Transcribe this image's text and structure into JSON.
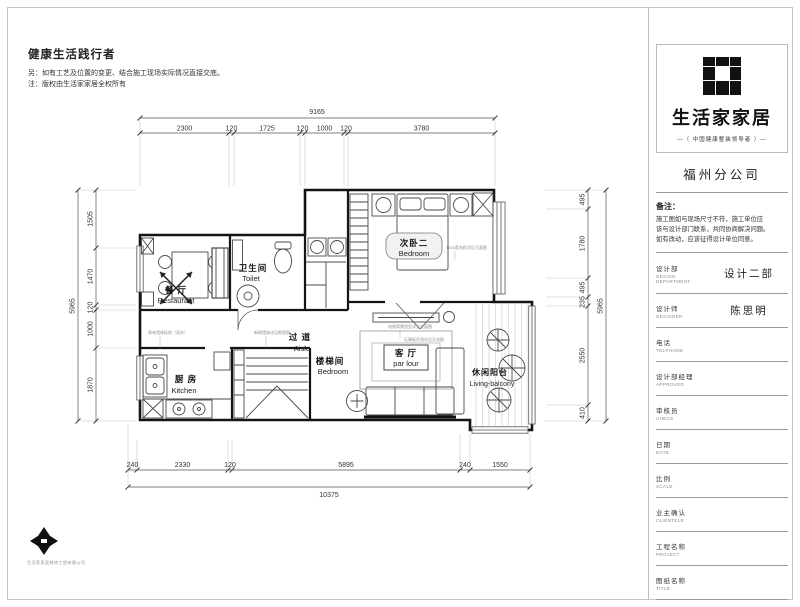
{
  "header": {
    "title": "健康生活践行者",
    "note1": "另：如有工艺及位置的变更、结合施工现场实际情况直接交底。",
    "note2": "注：版权由生活家家居全权所有"
  },
  "sidebar": {
    "brand": "生活家家居",
    "tagline": "—〔 中国健康整装领导者 〕—",
    "branch": "福州分公司",
    "remark_title": "备注：",
    "remark_lines": [
      "施工图如与现场尺寸不符，施工单位应",
      "该与设计部门联系，共同协商解决问题。",
      "如有改动，应该征得设计单位同意。"
    ],
    "fields": [
      {
        "cn": "设计部",
        "en": "DESIGN DEPARTMENT",
        "value": "设计二部"
      },
      {
        "cn": "设计师",
        "en": "DESIGNER",
        "value": "陈思明"
      },
      {
        "cn": "电话",
        "en": "TELPHONE",
        "value": ""
      },
      {
        "cn": "设计部经理",
        "en": "APPROVED",
        "value": ""
      },
      {
        "cn": "审核员",
        "en": "CHECK",
        "value": ""
      },
      {
        "cn": "日期",
        "en": "DATE",
        "value": ""
      },
      {
        "cn": "比例",
        "en": "SCALE",
        "value": ""
      },
      {
        "cn": "业主确认",
        "en": "CLIENTELE",
        "value": ""
      },
      {
        "cn": "工程名称",
        "en": "PROJECT",
        "value": ""
      },
      {
        "cn": "图纸名称",
        "en": "TITLE",
        "value": ""
      },
      {
        "cn": "图纸编号",
        "en": "· DWG NO",
        "value": ""
      }
    ]
  },
  "plan": {
    "rooms": [
      {
        "cn": "次卧二",
        "en": "Bedroom"
      },
      {
        "cn": "卫生间",
        "en": "Toilet"
      },
      {
        "cn": "餐 厅",
        "en": "Restaurant"
      },
      {
        "cn": "过 道",
        "en": "Aisle"
      },
      {
        "cn": "楼梯间",
        "en": "Bedroom"
      },
      {
        "cn": "客 厅",
        "en": "par lour"
      },
      {
        "cn": "休闲阳台",
        "en": "Living-balcony"
      },
      {
        "cn": "厨 房",
        "en": "Kitchen"
      }
    ],
    "annotations": [
      "原有墙体拆除（深灰）",
      "新砌墙体详见砌墙图",
      "电视背景造型详见立面图",
      "1200宽衣柜详见立面图",
      "石膏板吊顶详见天花图"
    ],
    "logo_caption": "生活家家居装饰工程有限公司"
  },
  "dims": {
    "top": {
      "overall": "9165",
      "segs": [
        "2300",
        "120",
        "1725",
        "120",
        "1000",
        "120",
        "3780"
      ]
    },
    "left": {
      "overall": "5965",
      "segs": [
        "1505",
        "1470",
        "120",
        "1000",
        "1870"
      ]
    },
    "right": {
      "overall": "5965",
      "segs": [
        "495",
        "1780",
        "495",
        "235",
        "2550",
        "410"
      ]
    },
    "bottom": {
      "overall": "10375",
      "segs": [
        "240",
        "2330",
        "120",
        "5895",
        "240",
        "1550"
      ]
    }
  }
}
